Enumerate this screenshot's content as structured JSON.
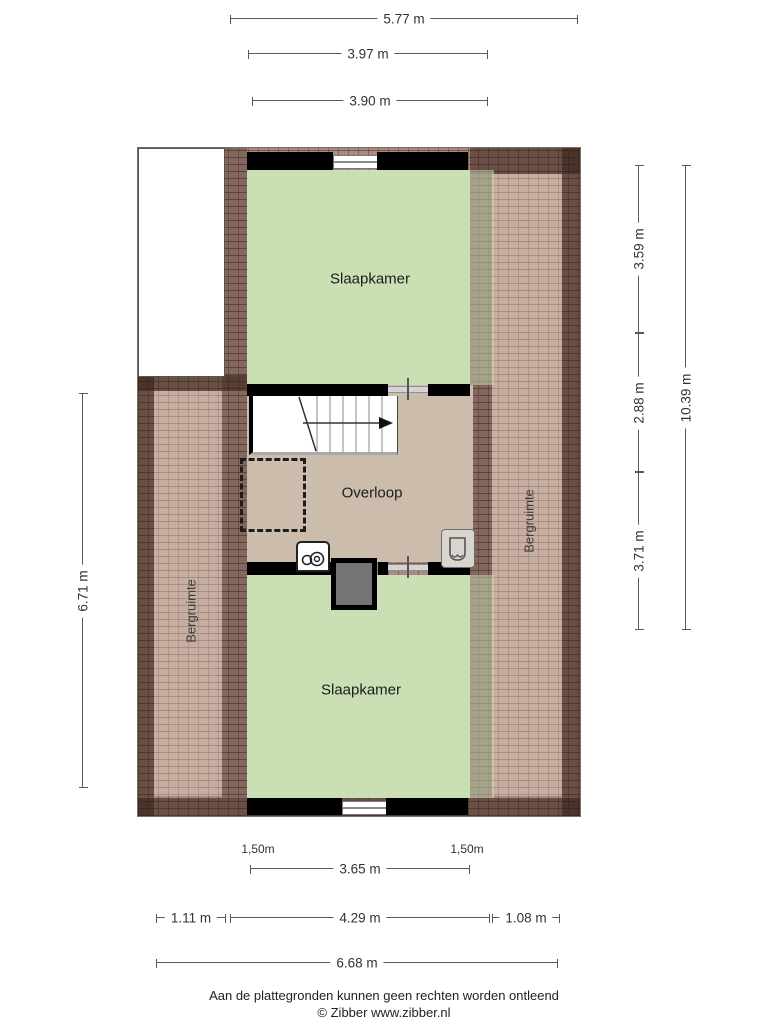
{
  "rooms": {
    "bedroom_top": "Slaapkamer",
    "landing": "Overloop",
    "bedroom_bottom": "Slaapkamer",
    "storage_left": "Bergruimte",
    "storage_right": "Bergruimte"
  },
  "dims": {
    "total_width_top": "5.77 m",
    "bedroom_top_width_a": "3.97 m",
    "bedroom_top_width_b": "3.90 m",
    "right_bedroom_top_depth": "3.59 m",
    "right_landing_depth": "2.88 m",
    "right_bedroom_bottom_depth": "3.71 m",
    "right_total_depth": "10.39 m",
    "left_height": "6.71 m",
    "headroom_left": "1,50m",
    "headroom_right": "1,50m",
    "bedroom_bottom_width": "3.65 m",
    "bottom_left_width": "1.11 m",
    "bottom_center_width": "4.29 m",
    "bottom_right_width": "1.08 m",
    "total_width_bottom": "6.68 m"
  },
  "footer": {
    "disclaimer": "Aan de plattegronden kunnen geen rechten worden ontleend",
    "credit": "© Zibber www.zibber.nl"
  },
  "icons": {
    "stairs": "stairs-with-direction-arrow",
    "washing_machine": "washing-machine-icon",
    "armchair": "armchair-icon",
    "chimney": "chimney-block",
    "roof_window": "dashed-roof-window-outline"
  },
  "colors": {
    "bedroom_fill": "#cadfb3",
    "landing_fill": "#cbbcab",
    "roof_tile": "#aa897e",
    "roof_edge_dark": "#3c2820",
    "wall": "#000000",
    "dimension_line": "#5a5a5a"
  }
}
